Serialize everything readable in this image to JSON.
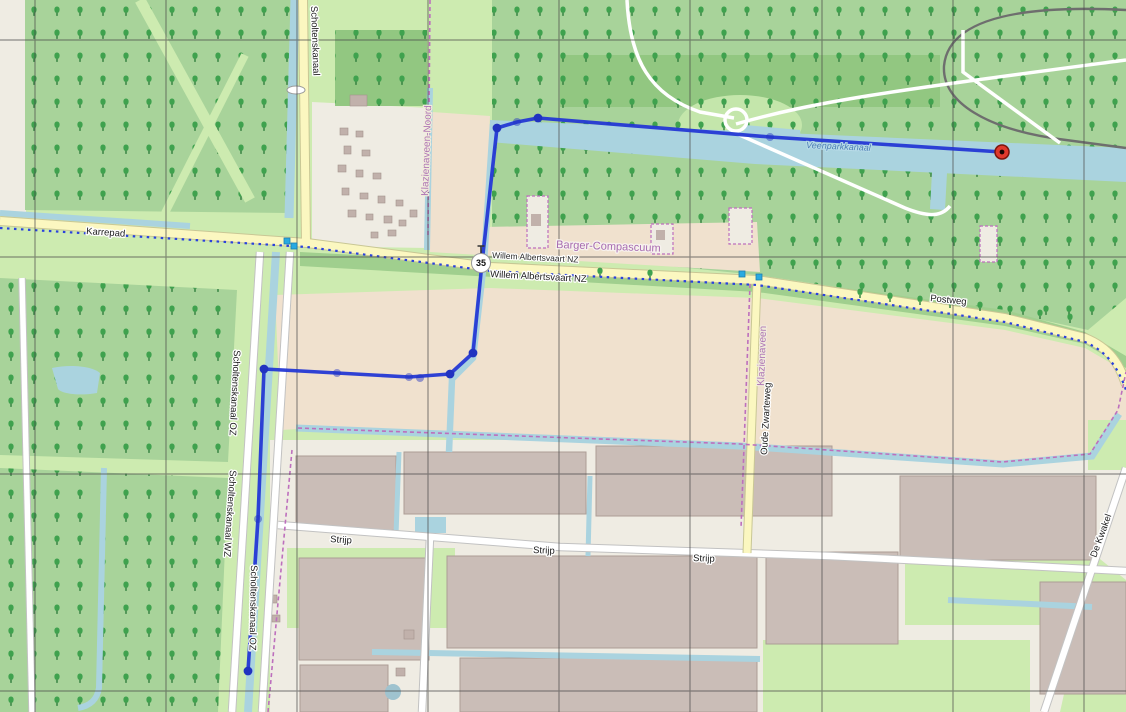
{
  "map": {
    "labels": {
      "scholtenskanaal_top": "Scholtenskanaal",
      "karrepad": "Karrepad",
      "klazienaveen_noord": "Klazienaveen-Noord",
      "barger_compascuum": "Barger-Compascuum",
      "willem_albertsvaart_nz_1": "Willem Albertsvaart NZ",
      "willem_albertsvaart_nz_2": "Willem Albertsvaart NZ",
      "postweg": "Postweg",
      "veenparkkanaal": "Veenparkkanaal",
      "klazienaveen": "Klazienaveen",
      "oude_zwarteweg": "Oude Zwarteweg",
      "scholtenskanaal_oz_1": "Scholtenskanaal OZ",
      "scholtenskanaal_wz": "Scholtenskanaal WZ",
      "scholtenskanaal_oz_2": "Scholtenskanaal OZ",
      "strijp_1": "Strijp",
      "strijp_2": "Strijp",
      "strijp_3": "Strijp",
      "de_kwakel": "De Kwakel"
    },
    "cycle_node": {
      "value": "35",
      "x": 481,
      "y": 263
    },
    "route": {
      "color": "#2438d4",
      "dot_color": "#2133c0",
      "points": [
        [
          248,
          671
        ],
        [
          258,
          519
        ],
        [
          264,
          369
        ],
        [
          337,
          373
        ],
        [
          409,
          377
        ],
        [
          450,
          374
        ],
        [
          473,
          353
        ],
        [
          482,
          263
        ],
        [
          497,
          128
        ],
        [
          517,
          122
        ],
        [
          538,
          118
        ],
        [
          770,
          137
        ],
        [
          1002,
          152
        ]
      ],
      "solid_dots": [
        [
          248,
          671
        ],
        [
          264,
          369
        ],
        [
          450,
          374
        ],
        [
          473,
          353
        ],
        [
          497,
          128
        ],
        [
          538,
          118
        ]
      ],
      "faint_dots": [
        [
          258,
          519
        ],
        [
          337,
          373
        ],
        [
          409,
          377
        ],
        [
          420,
          378
        ],
        [
          517,
          122
        ],
        [
          770,
          137
        ]
      ],
      "end_marker": {
        "x": 1002,
        "y": 152,
        "color": "#e0392c",
        "center_color": "#1a0503"
      }
    },
    "editor_nodes": [
      [
        287,
        241
      ],
      [
        294,
        246
      ],
      [
        742,
        274
      ],
      [
        759,
        277
      ]
    ],
    "editor_node_color": "#29aae1",
    "graticule": {
      "x": [
        35,
        166,
        297,
        428,
        559,
        690,
        822,
        953,
        1084
      ],
      "y": [
        40,
        257,
        474,
        691
      ],
      "color": "#4a4a4a"
    },
    "colors": {
      "grass": "#cdebb0",
      "forest": "#a8d39a",
      "forest_dark": "#92c781",
      "farmland": "#f0e1ce",
      "landuse_white": "#efece3",
      "water": "#aad3df",
      "road_yellow": "#fbf7c0",
      "road_white": "#ffffff",
      "building": "#cabdb7",
      "boundary_purple": "#bd6fbd",
      "cycle_route_blue": "#2a41dd",
      "rail_gray": "#6e6e6e"
    }
  }
}
